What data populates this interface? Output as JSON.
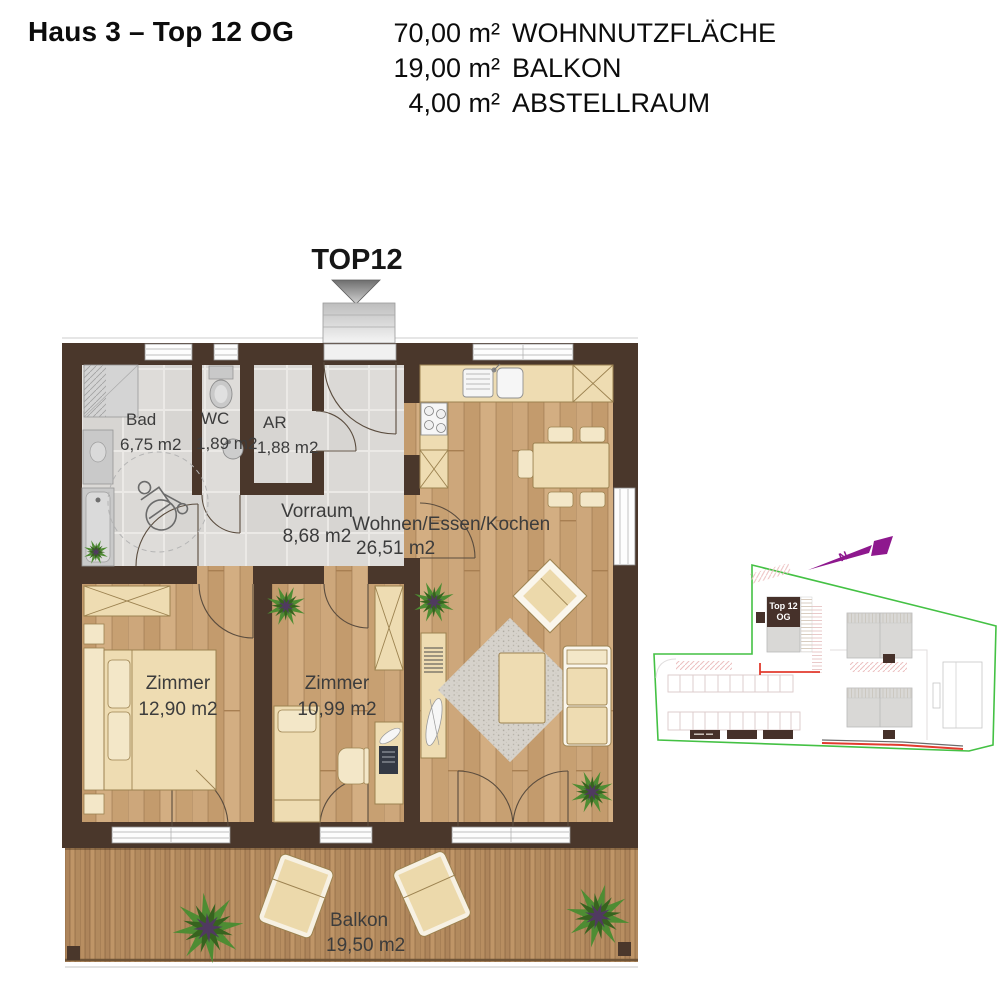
{
  "header": {
    "title": "Haus 3 – Top 12 OG",
    "areas": [
      {
        "value": "70,00 m²",
        "label": "WOHNNUTZFLÄCHE"
      },
      {
        "value": "19,00 m²",
        "label": "BALKON"
      },
      {
        "value": "4,00 m²",
        "label": "ABSTELLRAUM"
      }
    ]
  },
  "entrance": {
    "label": "TOP12"
  },
  "rooms": {
    "bad": {
      "name": "Bad",
      "area": "6,75 m2"
    },
    "wc": {
      "name": "WC",
      "area": "1,89 m2"
    },
    "ar": {
      "name": "AR",
      "area": "1,88 m2"
    },
    "vorraum": {
      "name": "Vorraum",
      "area": "8,68 m2"
    },
    "wohnen": {
      "name": "Wohnen/Essen/Kochen",
      "area": "26,51 m2"
    },
    "zimmer1": {
      "name": "Zimmer",
      "area": "12,90 m2"
    },
    "zimmer2": {
      "name": "Zimmer",
      "area": "10,99 m2"
    },
    "balkon": {
      "name": "Balkon",
      "area": "19,50 m2"
    }
  },
  "site_plan": {
    "unit_label_line1": "Top 12",
    "unit_label_line2": "OG",
    "north_label": "N"
  },
  "colors": {
    "wall_brown": "#4a372b",
    "wood_floor": "#c8a176",
    "tile_gray": "#dbd9d6",
    "furniture_cream": "#eedcb2",
    "boundary_green": "#44c144",
    "highlight_brown": "#46312a",
    "north_purple": "#8e188e",
    "accent_red": "#e23b2e"
  }
}
